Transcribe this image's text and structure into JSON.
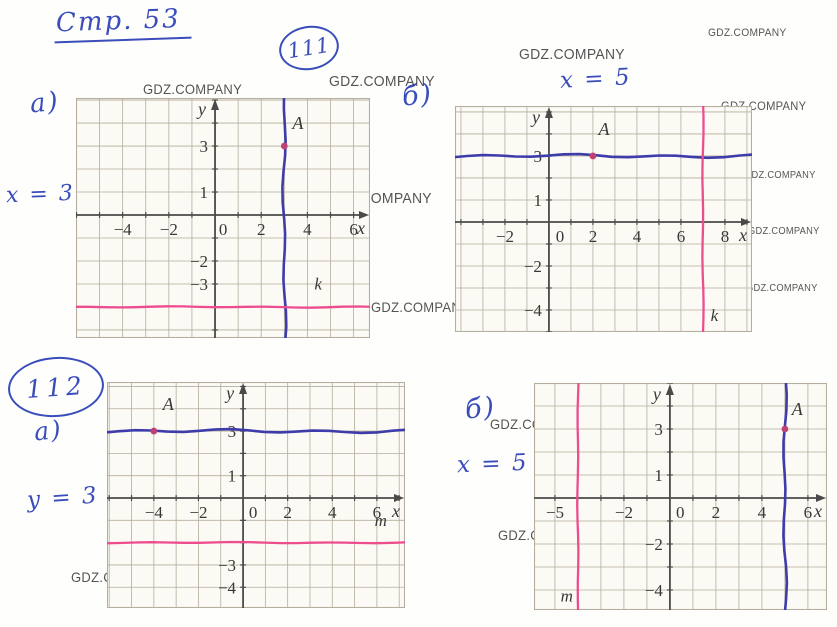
{
  "page": {
    "title": "Стр. 53"
  },
  "problems": [
    {
      "number": "111"
    },
    {
      "number": "112"
    }
  ],
  "annotations": [
    {
      "name": "part-label-111a",
      "text": "а)",
      "x": 30,
      "y": 88,
      "size": 26,
      "rotate": -6
    },
    {
      "name": "equation-x-equals-3",
      "text": "x = 3",
      "x": 6,
      "y": 182,
      "size": 22,
      "rotate": -2
    },
    {
      "name": "part-label-111b",
      "text": "б)",
      "x": 402,
      "y": 80,
      "size": 27,
      "rotate": -6
    },
    {
      "name": "equation-x-equals-5-top",
      "text": "x = 5",
      "x": 560,
      "y": 66,
      "size": 23,
      "rotate": -3
    },
    {
      "name": "part-label-112a",
      "text": "а)",
      "x": 34,
      "y": 416,
      "size": 25,
      "rotate": -6
    },
    {
      "name": "equation-y-equals-3",
      "text": "y = 3",
      "x": 27,
      "y": 485,
      "size": 23,
      "rotate": -4
    },
    {
      "name": "part-label-112b",
      "text": "б)",
      "x": 465,
      "y": 393,
      "size": 27,
      "rotate": -6
    },
    {
      "name": "equation-x-equals-5-bottom",
      "text": "x = 5",
      "x": 457,
      "y": 451,
      "size": 23,
      "rotate": -2
    }
  ],
  "watermark": {
    "text": "GDZ.COMPANY",
    "positions": [
      [
        143,
        81,
        14
      ],
      [
        329,
        73,
        15
      ],
      [
        131,
        189,
        15
      ],
      [
        326,
        190,
        15
      ],
      [
        371,
        299,
        14
      ],
      [
        519,
        46,
        15
      ],
      [
        708,
        27,
        11
      ],
      [
        721,
        99,
        12
      ],
      [
        534,
        159,
        15
      ],
      [
        744,
        170,
        10
      ],
      [
        748,
        226,
        10
      ],
      [
        746,
        283,
        10
      ],
      [
        559,
        263,
        14
      ],
      [
        111,
        386,
        14
      ],
      [
        299,
        407,
        14
      ],
      [
        261,
        518,
        14
      ],
      [
        71,
        569,
        14
      ],
      [
        490,
        416,
        14
      ],
      [
        677,
        412,
        14
      ],
      [
        498,
        527,
        14
      ],
      [
        687,
        542,
        14
      ]
    ]
  },
  "colors": {
    "ink": "#3a4dbb",
    "blue_line": "#3d3caa",
    "pink_line": "#ed4d8e",
    "point": "#bf4276",
    "axis": "#4a4a4a",
    "grid": "#b5ad9d",
    "tick_text": "#383838",
    "paper": "#fcfaf4",
    "watermark": "#3d3d3d"
  },
  "chart_data": [
    {
      "type": "line",
      "problem": "111",
      "part": "а",
      "container": "graph-111a",
      "xlim": [
        -6.02,
        6.71
      ],
      "ylim": [
        -5.35,
        5.09
      ],
      "x_label": "x",
      "y_label": "y",
      "zero_dx": 0.35,
      "x_ticks": [
        [
          -4,
          "−4"
        ],
        [
          -2,
          "−2"
        ],
        [
          0,
          "0"
        ],
        [
          2,
          "2"
        ],
        [
          4,
          "4"
        ],
        [
          6,
          "6"
        ]
      ],
      "y_ticks": [
        [
          3,
          "3"
        ],
        [
          1,
          "1"
        ],
        [
          -2,
          "−2"
        ],
        [
          -3,
          "−3"
        ]
      ],
      "lines": [
        {
          "name": "x = 3",
          "orient": "v",
          "at": 3,
          "color": "blue",
          "hand": true
        },
        {
          "name": "k",
          "orient": "h",
          "at": -4,
          "color": "pink",
          "label": "k",
          "label_at": [
            4.3,
            -3.25
          ]
        }
      ],
      "point": {
        "x": 3,
        "y": 3,
        "label": "A",
        "label_at": [
          3.35,
          3.75
        ]
      }
    },
    {
      "type": "line",
      "problem": "111",
      "part": "б",
      "container": "graph-111b",
      "xlim": [
        -4.27,
        9.23
      ],
      "ylim": [
        -5.0,
        5.27
      ],
      "x_label": "x",
      "y_label": "y",
      "zero_dx": 0.5,
      "x_ticks": [
        [
          -2,
          "−2"
        ],
        [
          0,
          "0"
        ],
        [
          2,
          "2"
        ],
        [
          4,
          "4"
        ],
        [
          6,
          "6"
        ],
        [
          8,
          "8"
        ]
      ],
      "y_ticks": [
        [
          3,
          "3"
        ],
        [
          1,
          "1"
        ],
        [
          -2,
          "−2"
        ],
        [
          -4,
          "−4"
        ]
      ],
      "lines": [
        {
          "name": "y = 3",
          "orient": "h",
          "at": 3,
          "color": "blue",
          "hand": true
        },
        {
          "name": "k",
          "orient": "v",
          "at": 7,
          "color": "pink",
          "label": "k",
          "label_at": [
            7.35,
            -4.5
          ]
        }
      ],
      "point": {
        "x": 2,
        "y": 3,
        "label": "A",
        "label_at": [
          2.25,
          3.95
        ]
      }
    },
    {
      "type": "line",
      "problem": "112",
      "part": "а",
      "container": "graph-112a",
      "xlim": [
        -6.1,
        7.26
      ],
      "ylim": [
        -4.93,
        5.2
      ],
      "x_label": "x",
      "y_label": "y",
      "zero_dx": 0.45,
      "x_ticks": [
        [
          -4,
          "−4"
        ],
        [
          -2,
          "−2"
        ],
        [
          0,
          "0"
        ],
        [
          2,
          "2"
        ],
        [
          4,
          "4"
        ],
        [
          6,
          "6"
        ]
      ],
      "y_ticks": [
        [
          3,
          "3"
        ],
        [
          1,
          "1"
        ],
        [
          -3,
          "−3"
        ],
        [
          -4,
          "−4"
        ]
      ],
      "lines": [
        {
          "name": "y = 3",
          "orient": "h",
          "at": 3,
          "color": "blue",
          "hand": true
        },
        {
          "name": "m",
          "orient": "h",
          "at": -2,
          "color": "pink",
          "label": "m",
          "label_at": [
            5.9,
            -1.25
          ]
        }
      ],
      "point": {
        "x": -4,
        "y": 3,
        "label": "A",
        "label_at": [
          -3.6,
          3.95
        ]
      }
    },
    {
      "type": "line",
      "problem": "112",
      "part": "б",
      "container": "graph-112b",
      "xlim": [
        -5.91,
        6.83
      ],
      "ylim": [
        -4.87,
        5.0
      ],
      "x_label": "x",
      "y_label": "y",
      "zero_dx": 0.45,
      "x_ticks": [
        [
          -5,
          "−5"
        ],
        [
          -2,
          "−2"
        ],
        [
          0,
          "0"
        ],
        [
          2,
          "2"
        ],
        [
          4,
          "4"
        ],
        [
          6,
          "6"
        ]
      ],
      "y_ticks": [
        [
          3,
          "3"
        ],
        [
          1,
          "1"
        ],
        [
          -2,
          "−2"
        ],
        [
          -4,
          "−4"
        ]
      ],
      "lines": [
        {
          "name": "x = 5",
          "orient": "v",
          "at": 5,
          "color": "blue",
          "hand": true
        },
        {
          "name": "m",
          "orient": "v",
          "at": -4,
          "color": "pink",
          "label": "m",
          "label_at": [
            -4.75,
            -4.5
          ]
        }
      ],
      "point": {
        "x": 5,
        "y": 3,
        "label": "A",
        "label_at": [
          5.3,
          3.6
        ]
      }
    }
  ]
}
